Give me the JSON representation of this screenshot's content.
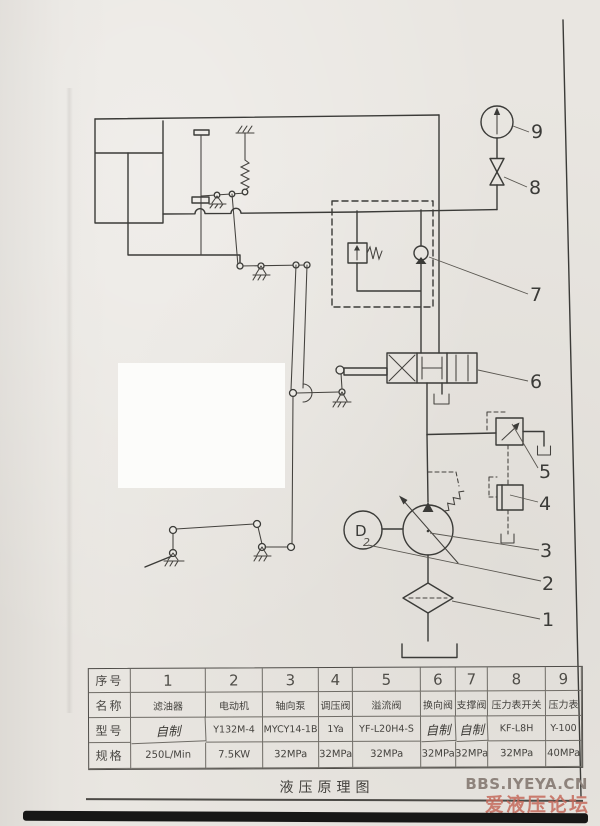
{
  "diagram": {
    "title": "液压原理图",
    "labels": {
      "l1": "1",
      "l2": "2",
      "l3": "3",
      "l4": "4",
      "l5": "5",
      "l6": "6",
      "l7": "7",
      "l8": "8",
      "l9": "9"
    },
    "motor_letter": "D",
    "motor_handwritten": "2"
  },
  "table": {
    "headers": {
      "index": "序号",
      "name": "名称",
      "model": "型号",
      "spec": "规格"
    },
    "columns": [
      {
        "no": "1",
        "name": "滤油器",
        "model": "自制",
        "spec": "250L/Min"
      },
      {
        "no": "2",
        "name": "电动机",
        "model": "Y132M-4",
        "spec": "7.5KW"
      },
      {
        "no": "3",
        "name": "轴向泵",
        "model": "MYCY14-1B",
        "spec": "32MPa"
      },
      {
        "no": "4",
        "name": "调压阀",
        "model": "1Ya",
        "spec": "32MPa"
      },
      {
        "no": "5",
        "name": "溢流阀",
        "model": "YF-L20H4-S",
        "spec": "32MPa"
      },
      {
        "no": "6",
        "name": "换向阀",
        "model": "自制",
        "spec": "32MPa"
      },
      {
        "no": "7",
        "name": "支撑阀",
        "model": "自制",
        "spec": "32MPa"
      },
      {
        "no": "8",
        "name": "压力表开关",
        "model": "KF-L8H",
        "spec": "32MPa"
      },
      {
        "no": "9",
        "name": "压力表",
        "model": "Y-100",
        "spec": "40MPa"
      }
    ]
  },
  "watermark": {
    "line1": "BBS.IYEYA.CN",
    "line2": "爱液压论坛"
  },
  "colors": {
    "paper": "#e9e6e1",
    "ink": "#3b3b38",
    "watermark_red": "#c4685a"
  }
}
